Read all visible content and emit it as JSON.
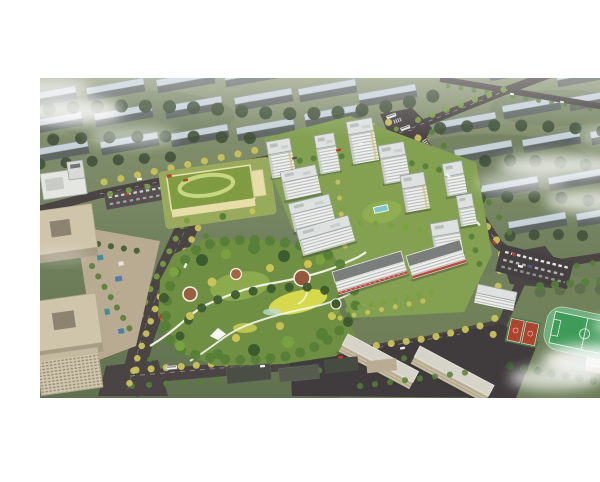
{
  "scene": {
    "type": "aerial-architectural-rendering",
    "description": "Bird's-eye architectural rendering of a residential development: white high-rise towers around green courtyards, a large landscaped central park with winding white paths and a yellow lawn, a kindergarten with a green roof and oval rooftop ring, beige office buildings on the left, a tree-lined boulevard, a school campus with a green sports field and red basketball courts at lower right, rows of gray apartment slabs with pale blue roofs in the surrounding city, major roads with buses and cars, and white clouds drifting over the edges of the view.",
    "has_text": false
  },
  "regions": {
    "photo": "aerial rendering photo",
    "background_city": "surrounding city blocks with pale blue roofed slabs",
    "background_trees": "tree belts between background blocks",
    "roads": "road network with junctions",
    "boulevard": "tree-lined boulevard",
    "offices": "beige office buildings with roof courtyards",
    "plaza": "office plaza with colored paving",
    "kindergarten": "kindergarten with green roof and oval rooftop ring",
    "central_park": "central landscaped park with paths, plazas and yellow lawn",
    "residential": "white residential towers with courtyard gardens",
    "retail_slabs": "residential slabs with red retail awnings",
    "school": "school campus buildings",
    "sports_field": "green sports field with running track",
    "basketball_courts": "red basketball courts",
    "parking": "parking lots with cars",
    "low_rises": "low-rise street buildings",
    "vehicles": "buses and cars on roads",
    "clouds": "white clouds and mist"
  },
  "palette": {
    "terrain_top": "#8a9575",
    "terrain_bottom": "#60714f",
    "bg_roof": "#c6d1d8",
    "bg_face": "#5f6663",
    "bg_tree": "#42523a",
    "road": "#4a4444",
    "road_line": "#d8d5cf",
    "tower_face": "#f0f1ef",
    "tower_side": "#c3c8c6",
    "tower_stripe": "#7c8484",
    "tower_roof": "#dde1df",
    "tower_roof_edge": "#98a09e",
    "slab_awning": "#c0392b",
    "courtyard": "#84a152",
    "park_base": "#6f8f43",
    "park_lawn": "#8fae4f",
    "park_yellow": "#d6da4a",
    "park_path": "#f4f3ec",
    "plaza_brown": "#9a5f41",
    "tree_dark": "#3c5c2f",
    "tree_mid": "#558036",
    "tree_light": "#79a23f",
    "tree_yellow": "#c9c355",
    "kg_roof": "#7f9c42",
    "kg_ring": "#c7d77f",
    "kg_wall": "#e7dda9",
    "office_beige": "#cfc5ab",
    "office_shadow": "#a69c84",
    "office_dark": "#8c8470",
    "school_beige": "#c8bda0",
    "field_track": "#6fb07d",
    "field_green": "#3f9b58",
    "court_red": "#b0432e",
    "water": "#7fc4cf",
    "cloud": "#ffffff"
  }
}
